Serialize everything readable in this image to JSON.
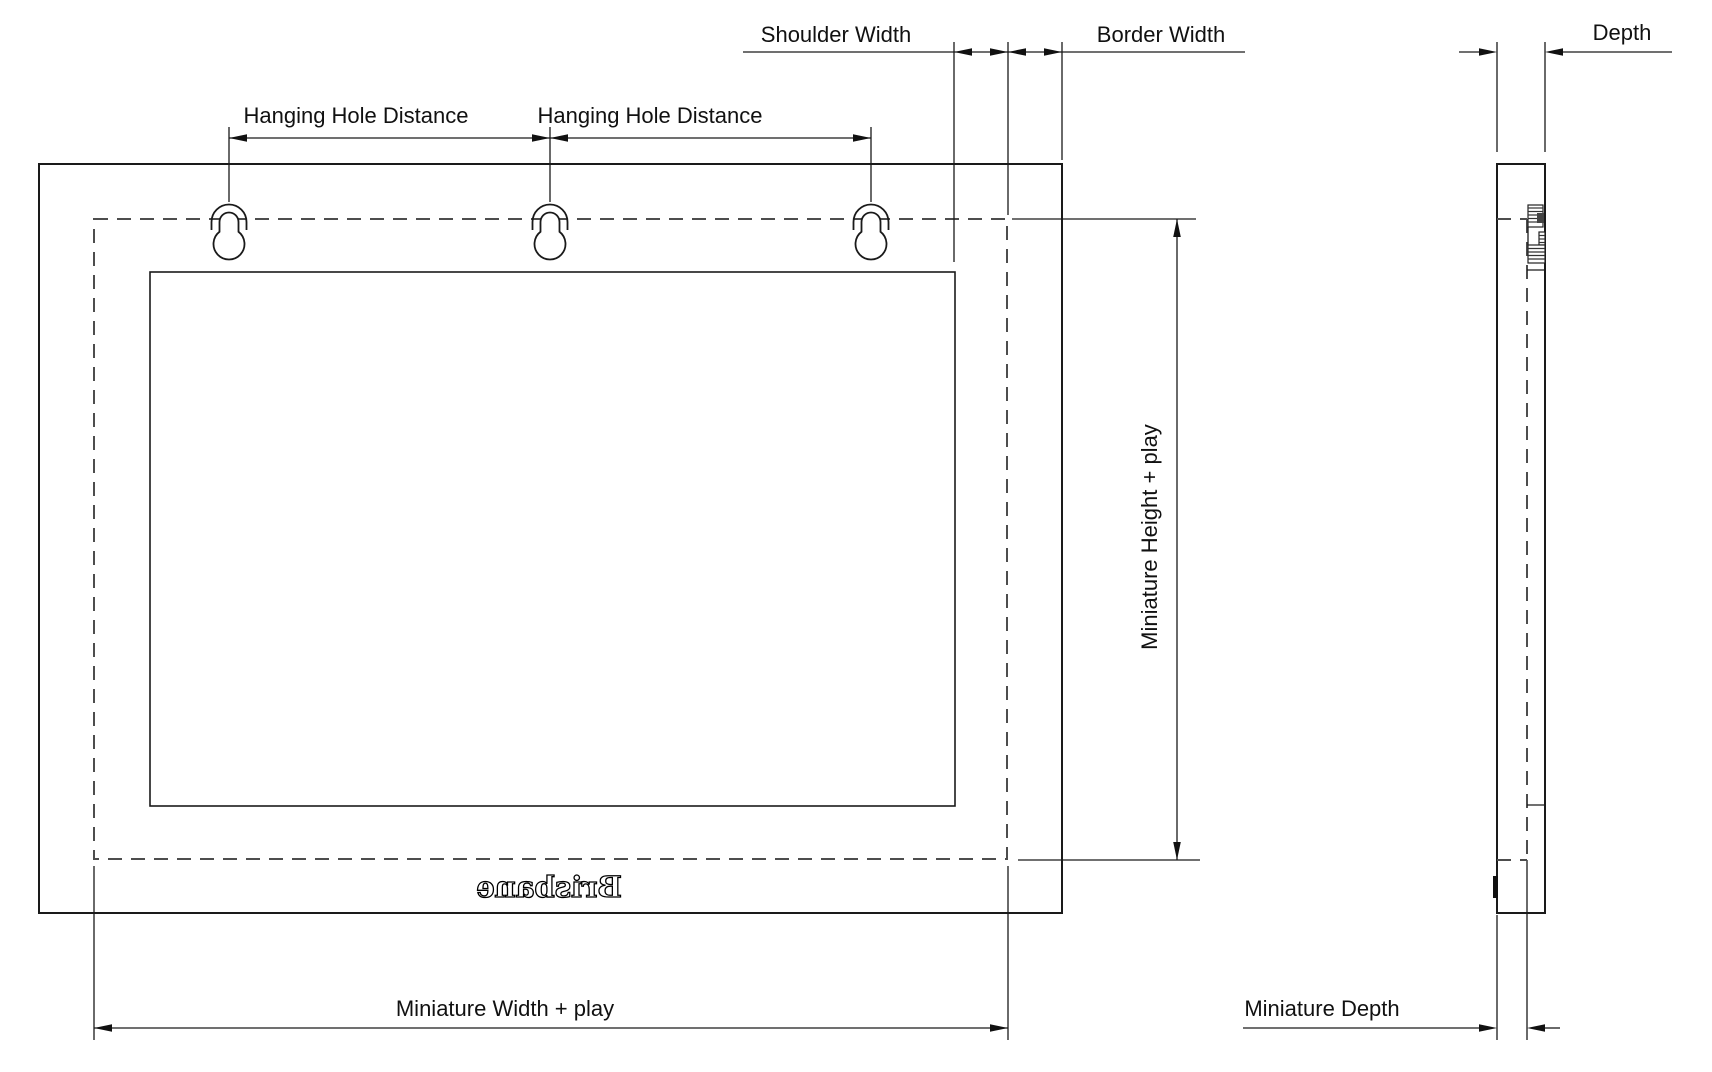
{
  "drawing": {
    "front_view": {
      "labels": {
        "hanging_hole_distance_left": "Hanging Hole Distance",
        "hanging_hole_distance_right": "Hanging Hole Distance",
        "shoulder_width": "Shoulder Width",
        "border_width": "Border Width",
        "miniature_height_play": "Miniature Height + play",
        "miniature_width_play": "Miniature Width + play"
      },
      "engraving_text": "Brisbane"
    },
    "side_view": {
      "labels": {
        "depth": "Depth",
        "miniature_depth": "Miniature Depth"
      }
    },
    "colors": {
      "line": "#1a1a1a",
      "dashed_line": "#4d4d4d",
      "background": "#ffffff",
      "text": "#111111"
    }
  }
}
